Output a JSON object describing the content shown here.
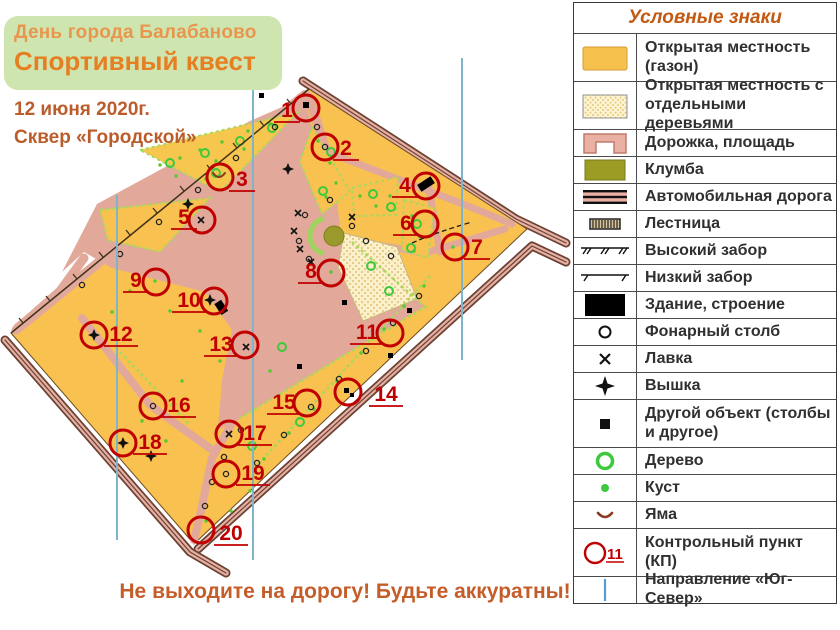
{
  "header": {
    "line1": "День города Балабаново",
    "line2": "Спортивный квест",
    "date": "12 июня 2020г.",
    "venue": "Сквер «Городской»"
  },
  "warning": "Не выходите на дорогу! Будьте аккуратны!",
  "legend": {
    "title": "Условные знаки",
    "cp_label": "11",
    "items": [
      {
        "label": "Открытая местность (газон)"
      },
      {
        "label": "Открытая местность с отдельными деревьями"
      },
      {
        "label": "Дорожка, площадь"
      },
      {
        "label": "Клумба"
      },
      {
        "label": "Автомобильная дорога"
      },
      {
        "label": "Лестница"
      },
      {
        "label": "Высокий забор"
      },
      {
        "label": "Низкий забор"
      },
      {
        "label": "Здание, строение"
      },
      {
        "label": "Фонарный столб"
      },
      {
        "label": "Лавка"
      },
      {
        "label": "Вышка"
      },
      {
        "label": "Другой объект (столбы и другое)"
      },
      {
        "label": "Дерево"
      },
      {
        "label": "Куст"
      },
      {
        "label": "Яма"
      },
      {
        "label": "Контрольный пункт (КП)"
      },
      {
        "label": "Направление  «Юг-Север»"
      }
    ]
  },
  "map": {
    "colors": {
      "open_ground": "#F8C150",
      "path": "#E2A99B",
      "flowerbed": "#9A992B",
      "control_red": "#C00000",
      "north_line": "#7FB5C9",
      "legend_blue": "#5B9BD5",
      "banner_green": "#CFE5B0"
    },
    "control_points": [
      {
        "n": "1",
        "cx": 306,
        "cy": 108,
        "lx": 287,
        "ly": 117
      },
      {
        "n": "2",
        "cx": 325,
        "cy": 147,
        "lx": 346,
        "ly": 155
      },
      {
        "n": "3",
        "cx": 220,
        "cy": 177,
        "lx": 242,
        "ly": 186
      },
      {
        "n": "4",
        "cx": 426,
        "cy": 186,
        "lx": 405,
        "ly": 192
      },
      {
        "n": "5",
        "cx": 202,
        "cy": 220,
        "lx": 184,
        "ly": 224
      },
      {
        "n": "6",
        "cx": 425,
        "cy": 224,
        "lx": 406,
        "ly": 230
      },
      {
        "n": "7",
        "cx": 455,
        "cy": 247,
        "lx": 477,
        "ly": 254
      },
      {
        "n": "8",
        "cx": 331,
        "cy": 273,
        "lx": 311,
        "ly": 278
      },
      {
        "n": "9",
        "cx": 156,
        "cy": 282,
        "lx": 136,
        "ly": 287
      },
      {
        "n": "10",
        "cx": 214,
        "cy": 301,
        "lx": 189,
        "ly": 307
      },
      {
        "n": "11",
        "cx": 390,
        "cy": 333,
        "lx": 367,
        "ly": 339
      },
      {
        "n": "12",
        "cx": 94,
        "cy": 335,
        "lx": 121,
        "ly": 341
      },
      {
        "n": "13",
        "cx": 245,
        "cy": 345,
        "lx": 221,
        "ly": 351
      },
      {
        "n": "14",
        "cx": 348,
        "cy": 392,
        "lx": 386,
        "ly": 401
      },
      {
        "n": "15",
        "cx": 307,
        "cy": 403,
        "lx": 284,
        "ly": 409
      },
      {
        "n": "16",
        "cx": 153,
        "cy": 406,
        "lx": 179,
        "ly": 412
      },
      {
        "n": "17",
        "cx": 229,
        "cy": 434,
        "lx": 255,
        "ly": 440
      },
      {
        "n": "18",
        "cx": 123,
        "cy": 443,
        "lx": 150,
        "ly": 449
      },
      {
        "n": "19",
        "cx": 226,
        "cy": 474,
        "lx": 253,
        "ly": 480
      },
      {
        "n": "20",
        "cx": 201,
        "cy": 530,
        "lx": 231,
        "ly": 540
      }
    ]
  }
}
